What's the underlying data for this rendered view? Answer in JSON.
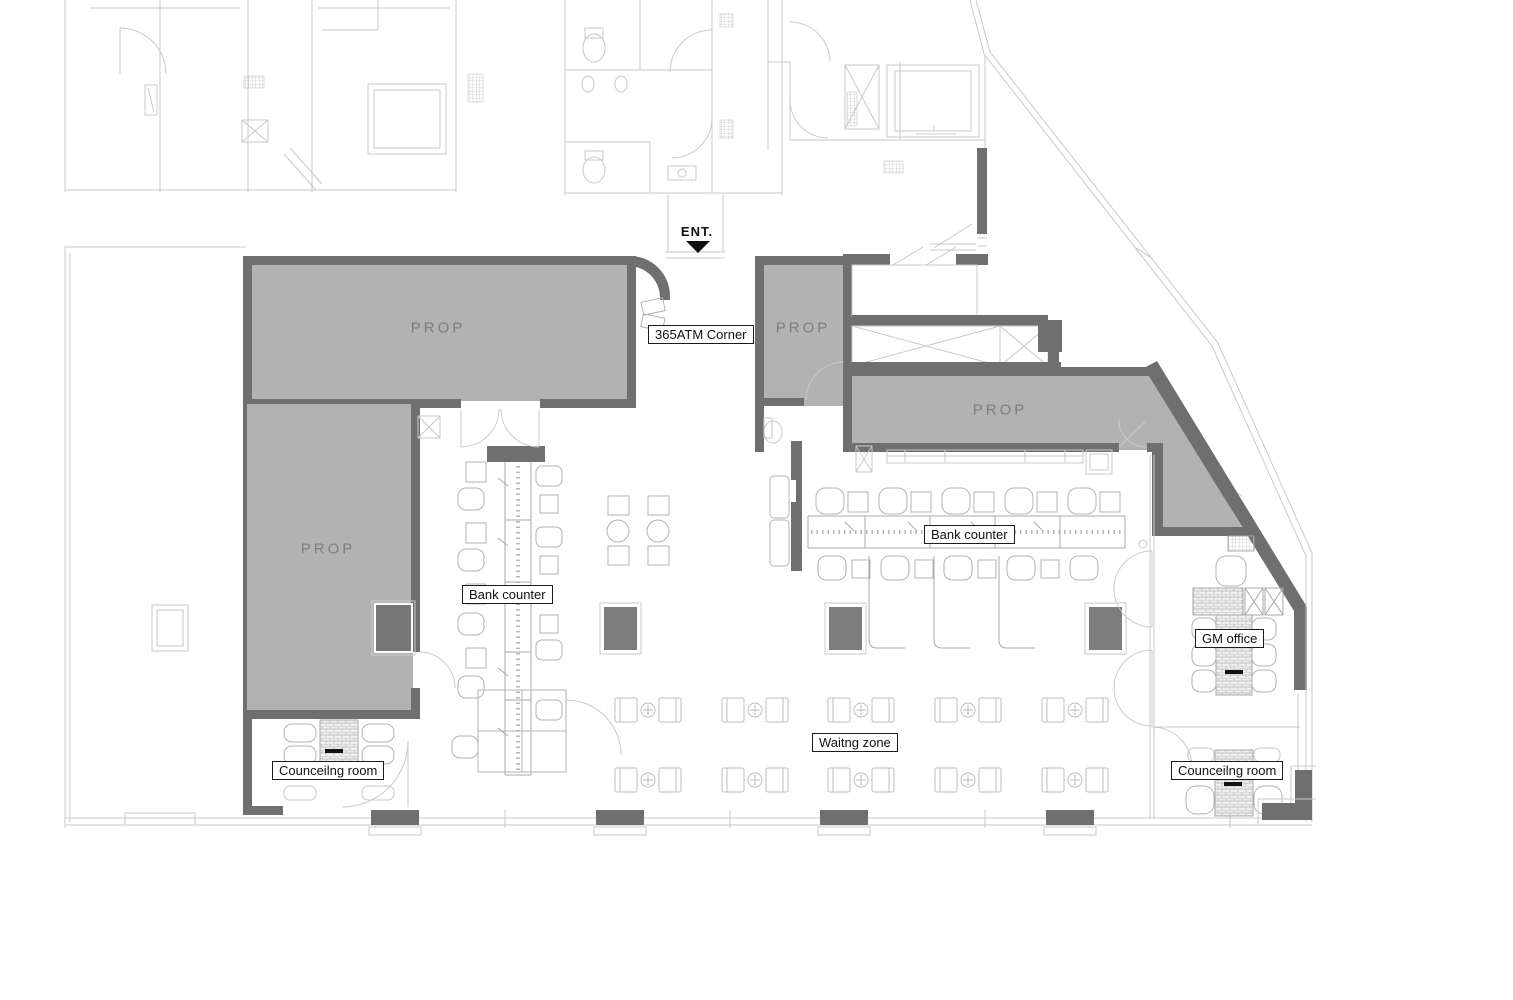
{
  "document": {
    "type": "floor-plan",
    "description": "Bank branch layout plan"
  },
  "colors": {
    "wall": "#6f6f6f",
    "room_fill": "#b2b2b2",
    "column_fill": "#7d7d7d",
    "prop_text": "#7e7e7e",
    "background_line": "#c9c9c9",
    "furniture_line": "#b3b3b3",
    "label_bg": "#ffffff",
    "label_border": "#1a1a1a",
    "label_text": "#111111",
    "entrance_arrow": "#111111"
  },
  "entrance": {
    "label": "ENT."
  },
  "rooms": {
    "atm_corner": {
      "label": "365ATM Corner"
    },
    "prop_top_left": {
      "label": "PROP"
    },
    "prop_left": {
      "label": "PROP"
    },
    "prop_entry": {
      "label": "PROP"
    },
    "prop_right": {
      "label": "PROP"
    },
    "gm_office": {
      "label": "GM office"
    },
    "counseling_left": {
      "label": "Counceilng room"
    },
    "counseling_right": {
      "label": "Counceilng room"
    }
  },
  "zones": {
    "bank_counter_left": {
      "label": "Bank counter"
    },
    "bank_counter_right": {
      "label": "Bank counter"
    },
    "waiting": {
      "label": "Waitng zone"
    }
  }
}
